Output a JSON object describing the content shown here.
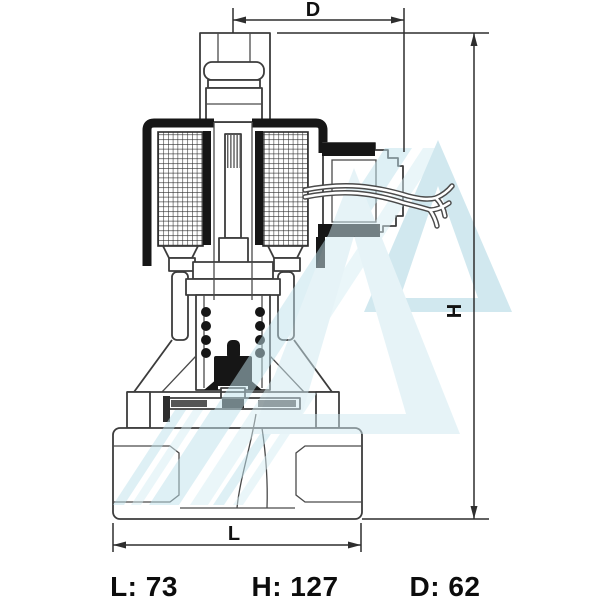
{
  "diagram": {
    "kind": "technical dimension drawing",
    "subject": "solenoid valve cross-section",
    "labels": {
      "d": "D",
      "h": "H",
      "l": "L"
    },
    "values": {
      "l": "L: 73",
      "h": "H: 127",
      "d": "D: 62"
    },
    "colors": {
      "background": "#ffffff",
      "line": "#3c3c3c",
      "solid_fill": "#161616",
      "text": "#0c0c0c",
      "watermark_light": "#cfe9f1",
      "watermark_mid": "#a4d2e0",
      "watermark_stripe": "#bfe2ec"
    }
  }
}
